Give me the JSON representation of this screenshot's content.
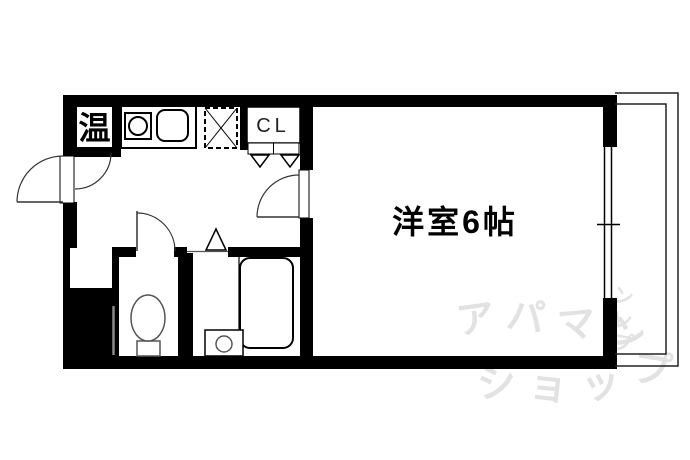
{
  "floorplan": {
    "main_room_label": "洋室6帖",
    "closet_label": "CL",
    "water_heater_label": "温",
    "colors": {
      "wall": "#000000",
      "background": "#ffffff",
      "watermark": "#e2e2e2",
      "step_line": "#8a8a8a"
    },
    "watermark": {
      "line1_chars": [
        "ア",
        "パ",
        "マ",
        "ン"
      ],
      "side_chars": [
        "ン",
        "レ",
        "プ"
      ],
      "line2_chars": [
        "シ",
        "ョ",
        "ッ",
        "プ"
      ]
    }
  }
}
